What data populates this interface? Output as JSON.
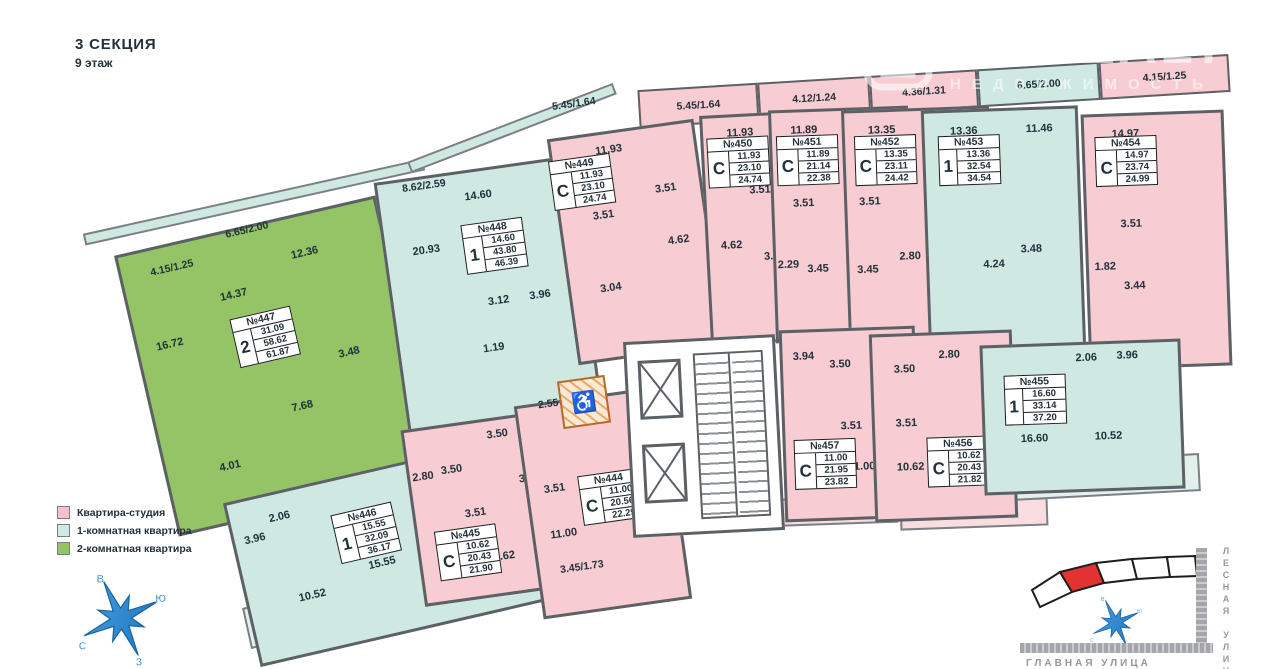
{
  "title": {
    "section": "3 СЕКЦИЯ",
    "floor": "9 этаж"
  },
  "watermark": {
    "brand": "ONREALT",
    "subtitle": "НЕДВИЖИМОСТЬ"
  },
  "legend": [
    {
      "label": "Квартира-студия",
      "color": "#f5c2ca"
    },
    {
      "label": "1-комнатная квартира",
      "color": "#cfe8e2"
    },
    {
      "label": "2-комнатная квартира",
      "color": "#94c465"
    }
  ],
  "compass": {
    "top": "В",
    "right": "Ю",
    "left": "С",
    "bottom": "З"
  },
  "minimap": {
    "street_side": "ЛЕСНАЯ УЛИЦА",
    "street_bottom": "ГЛАВНАЯ УЛИЦА",
    "highlight_color": "#e23333",
    "compass": {
      "top": "В",
      "right": "Ю",
      "left": "С",
      "bottom": "З"
    }
  },
  "corridor": {
    "area": "2.55"
  },
  "dims": [
    "4.15/1.25",
    "6.65/2.00",
    "8.62/2.59",
    "5.45/1.64",
    "5.45/1.64",
    "4.12/1.24",
    "4.36/1.31",
    "6.65/2.00",
    "4.15/1.25",
    "8.16/4.08",
    "4.91/1.47",
    "3.45/1.73",
    "3.73/1.87",
    "4.63/1.39",
    "8.12/4.06"
  ],
  "apartments": [
    {
      "number": "№444",
      "type": "С",
      "a1": "11.00",
      "a2": "20.56",
      "a3": "22.29",
      "rooms": [
        "3.51",
        "11.00"
      ]
    },
    {
      "number": "№445",
      "type": "С",
      "a1": "10.62",
      "a2": "20.43",
      "a3": "21.90",
      "rooms": [
        "3.50",
        "3.50",
        "3.51",
        "3.51",
        "2.80",
        "10.62"
      ]
    },
    {
      "number": "№446",
      "type": "1",
      "a1": "15.55",
      "a2": "32.09",
      "a3": "36.17",
      "rooms": [
        "2.06",
        "3.96",
        "15.55",
        "10.52"
      ]
    },
    {
      "number": "№447",
      "type": "2",
      "a1": "31.09",
      "a2": "58.62",
      "a3": "61.87",
      "rooms": [
        "16.72",
        "14.37",
        "12.36",
        "3.48",
        "7.68",
        "4.01"
      ]
    },
    {
      "number": "№448",
      "type": "1",
      "a1": "14.60",
      "a2": "43.80",
      "a3": "46.39",
      "rooms": [
        "20.93",
        "14.60",
        "3.12",
        "3.96",
        "1.19"
      ]
    },
    {
      "number": "№449",
      "type": "С",
      "a1": "11.93",
      "a2": "23.10",
      "a3": "24.74",
      "rooms": [
        "11.93",
        "3.51",
        "3.51",
        "4.62",
        "3.04"
      ]
    },
    {
      "number": "№450",
      "type": "С",
      "a1": "11.93",
      "a2": "23.10",
      "a3": "24.74",
      "rooms": [
        "11.93",
        "3.51",
        "4.62",
        "3.04"
      ]
    },
    {
      "number": "№451",
      "type": "С",
      "a1": "11.89",
      "a2": "21.14",
      "a3": "22.38",
      "rooms": [
        "11.89",
        "3.51",
        "2.29",
        "3.45"
      ]
    },
    {
      "number": "№452",
      "type": "С",
      "a1": "13.35",
      "a2": "23.11",
      "a3": "24.42",
      "rooms": [
        "13.35",
        "3.51",
        "3.45",
        "2.80"
      ]
    },
    {
      "number": "№453",
      "type": "1",
      "a1": "13.36",
      "a2": "32.54",
      "a3": "34.54",
      "rooms": [
        "13.36",
        "11.46",
        "4.24",
        "3.48"
      ]
    },
    {
      "number": "№454",
      "type": "С",
      "a1": "14.97",
      "a2": "23.74",
      "a3": "24.99",
      "rooms": [
        "14.97",
        "3.51",
        "1.82",
        "3.44"
      ]
    },
    {
      "number": "№455",
      "type": "1",
      "a1": "16.60",
      "a2": "33.14",
      "a3": "37.20",
      "rooms": [
        "2.06",
        "3.96",
        "16.60",
        "10.52"
      ]
    },
    {
      "number": "№456",
      "type": "С",
      "a1": "10.62",
      "a2": "20.43",
      "a3": "21.82",
      "rooms": [
        "2.80",
        "3.50",
        "3.51",
        "10.62"
      ]
    },
    {
      "number": "№457",
      "type": "С",
      "a1": "11.00",
      "a2": "21.95",
      "a3": "23.82",
      "rooms": [
        "3.94",
        "3.50",
        "3.51",
        "11.00"
      ]
    }
  ]
}
